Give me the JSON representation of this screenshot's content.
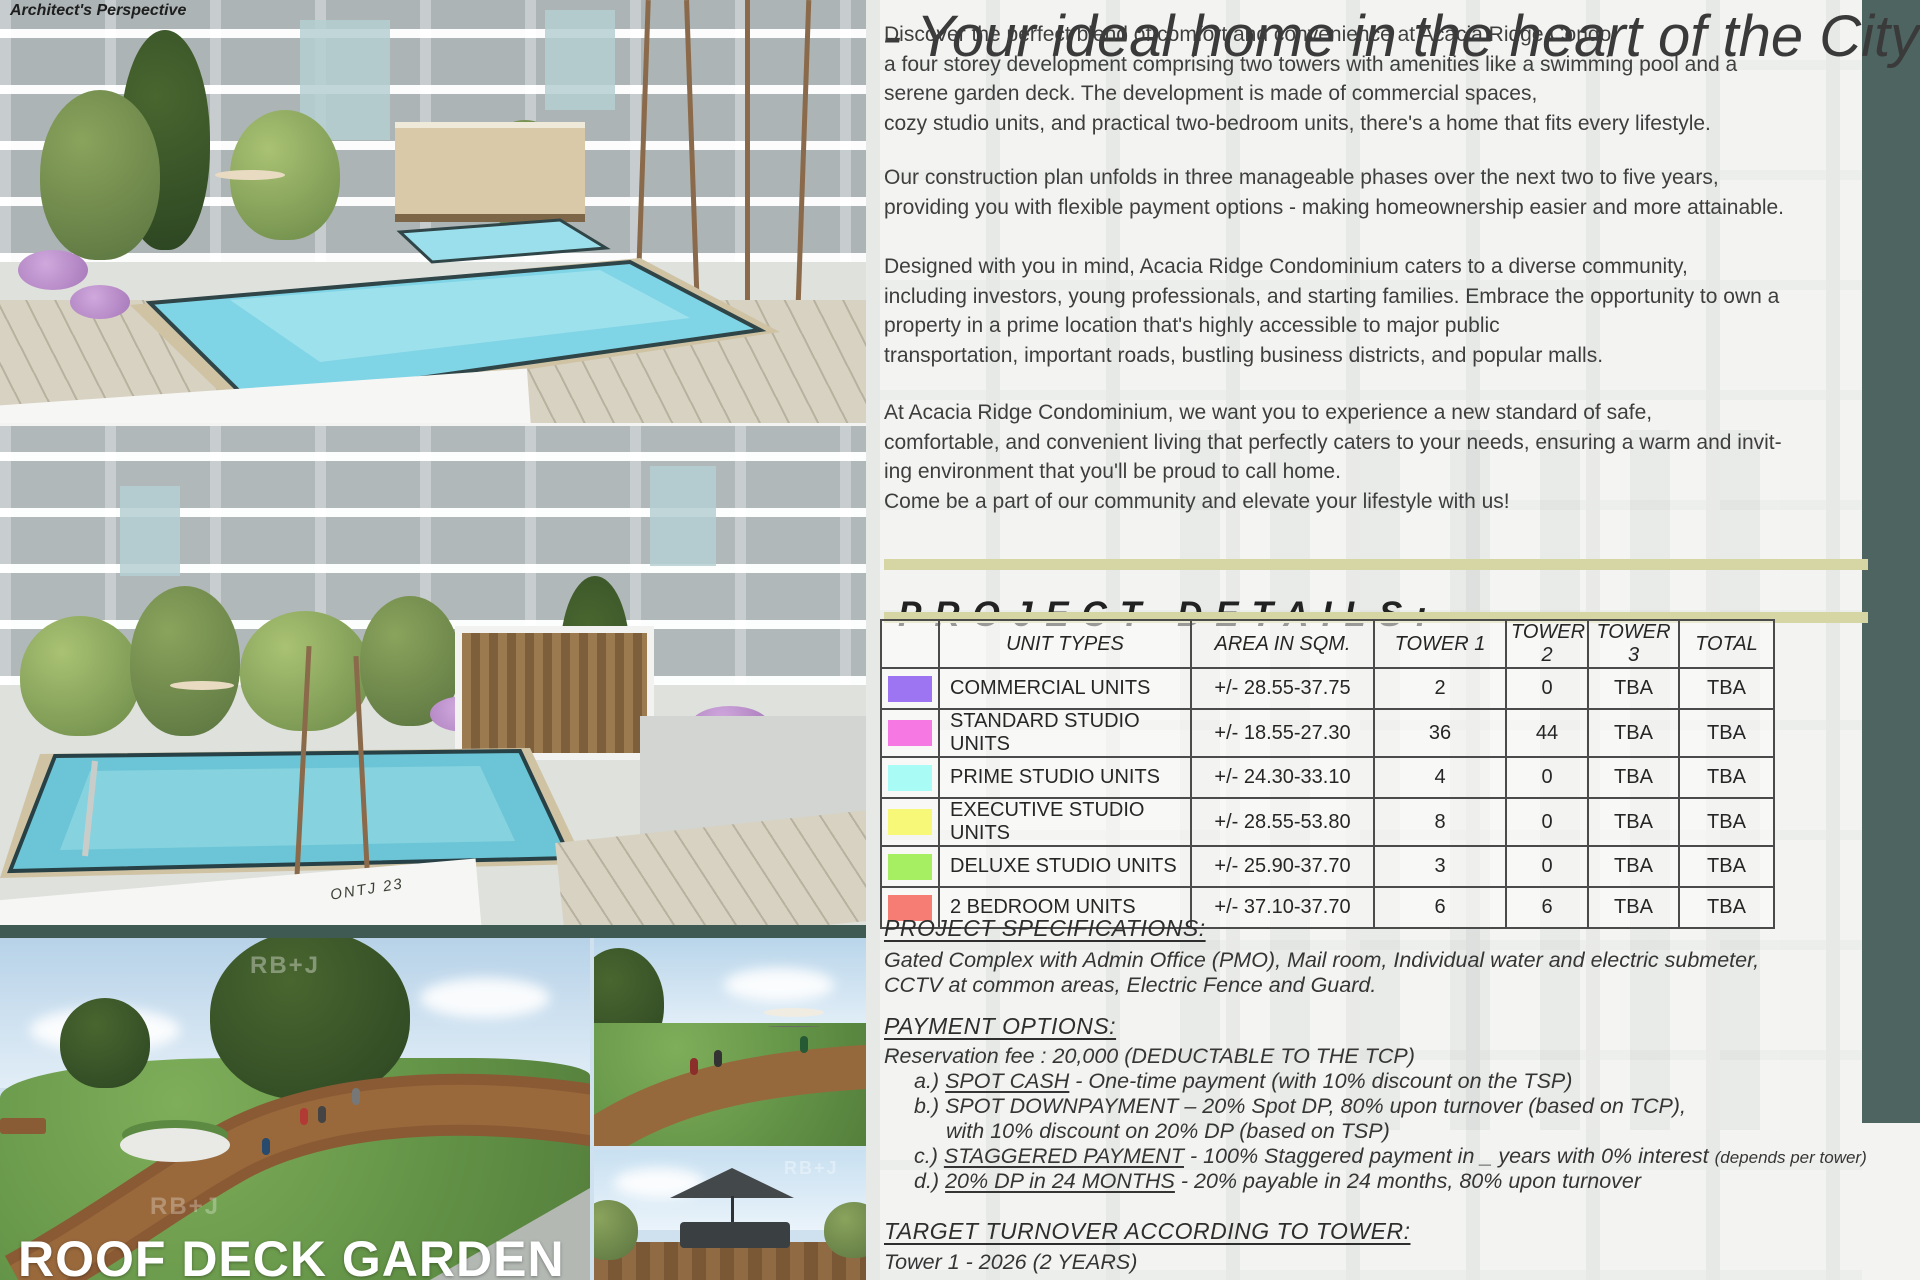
{
  "meta": {
    "architect_label": "Architect's Perspective",
    "roof_deck_title": "ROOF DECK GARDEN",
    "watermark": "RB+J",
    "sketch_signature": "ONTJ 23"
  },
  "colors": {
    "accent_olive": "#d5d6a4",
    "accent_teal": "#4e6461",
    "pool_blue": "#7fd4e6"
  },
  "hero": {
    "title": "- Your ideal home in the heart of the City!",
    "paragraphs": [
      [
        "Discover the perfect blend of comfort and convenience at Acacia Ridge Condo,",
        "a four storey development comprising two towers with amenities like a swimming pool and a",
        "serene garden deck. The development is made of commercial spaces,",
        "cozy studio units, and practical two-bedroom units, there's a home that fits every lifestyle."
      ],
      [
        "Our construction plan unfolds in three manageable phases over the next two to five years,",
        "providing you with flexible payment options - making homeownership easier and more attainable."
      ],
      [
        "Designed with you in mind, Acacia Ridge Condominium caters to a diverse community,",
        "including investors, young professionals, and starting families. Embrace the opportunity to own a",
        "property in a prime location that's highly accessible to major public",
        "transportation, important roads, bustling business districts, and popular malls."
      ],
      [
        "At Acacia Ridge Condominium, we want you to experience a new standard of safe,",
        "comfortable, and convenient living that perfectly caters to your needs, ensuring a warm and invit-",
        "ing environment that you'll be proud to call home.",
        "Come be a part of our community and elevate your lifestyle with us!"
      ]
    ]
  },
  "project_details": {
    "heading": "PROJECT DETAILS:",
    "table": {
      "headers": [
        "",
        "UNIT TYPES",
        "AREA IN SQM.",
        "TOWER 1",
        "TOWER 2",
        "TOWER 3",
        "TOTAL"
      ],
      "col_widths": [
        58,
        252,
        183,
        132,
        82,
        91,
        95
      ],
      "rows": [
        {
          "swatch": "#9d74f1",
          "unit_type": "COMMERCIAL UNITS",
          "area": "+/- 28.55-37.75",
          "tower1": "2",
          "tower2": "0",
          "tower3": "TBA",
          "total": "TBA"
        },
        {
          "swatch": "#f678e2",
          "unit_type": "STANDARD STUDIO UNITS",
          "area": "+/- 18.55-27.30",
          "tower1": "36",
          "tower2": "44",
          "tower3": "TBA",
          "total": "TBA"
        },
        {
          "swatch": "#a9fcf5",
          "unit_type": "PRIME  STUDIO UNITS",
          "area": "+/- 24.30-33.10",
          "tower1": "4",
          "tower2": "0",
          "tower3": "TBA",
          "total": "TBA"
        },
        {
          "swatch": "#f8f878",
          "unit_type": "EXECUTIVE STUDIO UNITS",
          "area": "+/- 28.55-53.80",
          "tower1": "8",
          "tower2": "0",
          "tower3": "TBA",
          "total": "TBA"
        },
        {
          "swatch": "#a7ef62",
          "unit_type": "DELUXE STUDIO UNITS",
          "area": "+/- 25.90-37.70",
          "tower1": "3",
          "tower2": "0",
          "tower3": "TBA",
          "total": "TBA"
        },
        {
          "swatch": "#f57d73",
          "unit_type": "2 BEDROOM UNITS",
          "area": "+/- 37.10-37.70",
          "tower1": "6",
          "tower2": "6",
          "tower3": "TBA",
          "total": "TBA"
        }
      ]
    }
  },
  "specifications": {
    "heading": "PROJECT SPECIFICATIONS:",
    "lines": [
      "Gated Complex with Admin Office (PMO), Mail room, Individual water and electric submeter,",
      "CCTV at common areas, Electric Fence and Guard."
    ]
  },
  "payment": {
    "heading": "PAYMENT OPTIONS:",
    "intro": "Reservation fee : 20,000 (DEDUCTABLE TO THE TCP)",
    "options": [
      {
        "prefix": "a.) ",
        "name": "SPOT CASH",
        "underline": true,
        "rest": " -  One-time payment (with 10% discount on the TSP)",
        "cont": "",
        "note": ""
      },
      {
        "prefix": "b.) ",
        "name": "SPOT DOWNPAYMENT",
        "underline": false,
        "rest": " – 20% Spot DP, 80% upon turnover (based on TCP),",
        "cont": "with 10% discount on 20% DP (based on TSP)",
        "note": ""
      },
      {
        "prefix": "c.) ",
        "name": "STAGGERED PAYMENT",
        "underline": true,
        "rest": " - 100% Staggered payment in _ years with 0% interest ",
        "cont": "",
        "note": "(depends per tower)"
      },
      {
        "prefix": "d.) ",
        "name": "20% DP in 24 MONTHS",
        "underline": true,
        "rest": " - 20% payable in 24 months, 80% upon turnover",
        "cont": "",
        "note": ""
      }
    ]
  },
  "turnover": {
    "heading": "TARGET TURNOVER ACCORDING TO TOWER:",
    "lines": [
      "Tower 1 - 2026 (2 YEARS)"
    ]
  }
}
